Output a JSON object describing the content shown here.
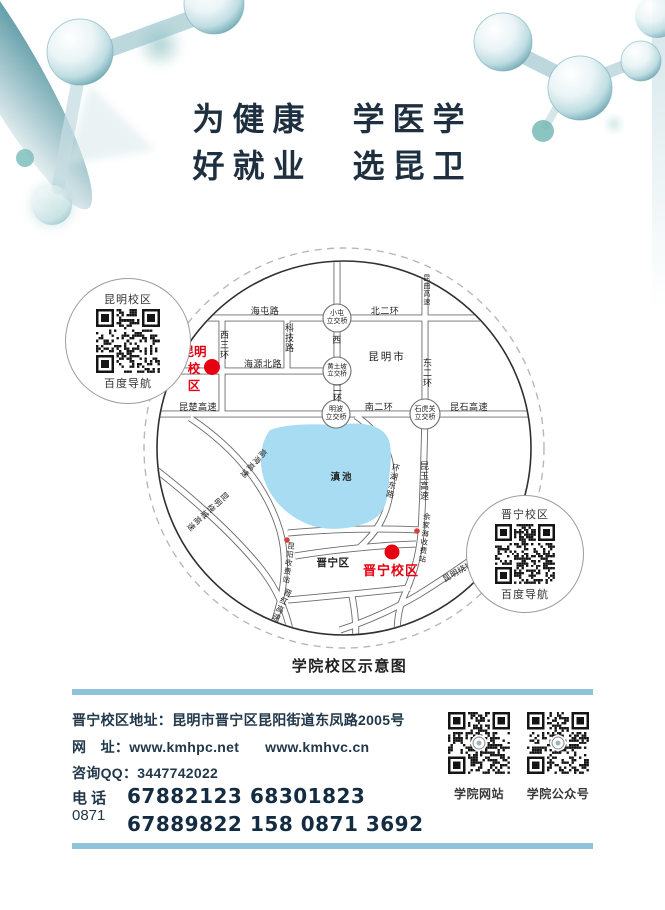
{
  "slogan": {
    "line1": "为健康　学医学",
    "line2": "好就业　选昆卫"
  },
  "map": {
    "caption": "学院校区示意图",
    "labels": {
      "haitun_rd": "海屯路",
      "north_2nd_ring": "北二环",
      "kunqu_expwy": "昆曲高速",
      "west_3rd_ring": "西三环",
      "keji_rd": "科技路",
      "west_label": "西",
      "second_ring": "二环",
      "east_2nd_ring": "东二环",
      "haiyuan_north_rd": "海源北路",
      "kunchu_expwy": "昆楚高速",
      "south_2nd_ring": "南二环",
      "kunshi_expwy": "昆石高速",
      "kunming_city": "昆明市",
      "dianchi_lake": "滇池",
      "huanhu_east_rd": "环湖东路",
      "kunyu_expwy": "昆玉高速",
      "gaohai_expwy": "高海高速",
      "raocheng_w": "昆明绕城高速",
      "raocheng_se": "昆明绕城高速",
      "yujiahai_toll": "余家海收费站",
      "kunyang_toll": "昆阳收费站",
      "jinhong_expwy": "晋红高速",
      "jinning_district": "晋宁区"
    },
    "interchanges": {
      "xiaotun": [
        "小屯",
        "立交桥"
      ],
      "huangtupo": [
        "黄土坡",
        "立交桥"
      ],
      "mingbo": [
        "明波",
        "立交桥"
      ],
      "shihuguan": [
        "石虎关",
        "立交桥"
      ]
    },
    "campus_kunming": {
      "row1": "昆明",
      "row2": "校",
      "row3": "区"
    },
    "campus_jinning": "晋宁校区",
    "qr_left": {
      "title": "昆明校区",
      "caption": "百度导航"
    },
    "qr_right": {
      "title": "晋宁校区",
      "caption": "百度导航"
    }
  },
  "contact": {
    "address": "晋宁校区地址：昆明市晋宁区昆阳街道东凤路2005号",
    "web_label": "网　址：",
    "url1": "www.kmhpc.net",
    "url2": "www.kmhvc.cn",
    "qq": "咨询QQ：3447742022",
    "phone_label": "电 话",
    "area_code": "0871",
    "numbers": [
      "67882123",
      "68301823",
      "67889822",
      "158 0871 3692"
    ],
    "qr_site_label": "学院网站",
    "qr_wechat_label": "学院公众号"
  },
  "colors": {
    "accent_red": "#e60012",
    "lake_blue": "#a8dcf2",
    "bar_blue": "#8fc3d9",
    "ink": "#1e3040"
  }
}
